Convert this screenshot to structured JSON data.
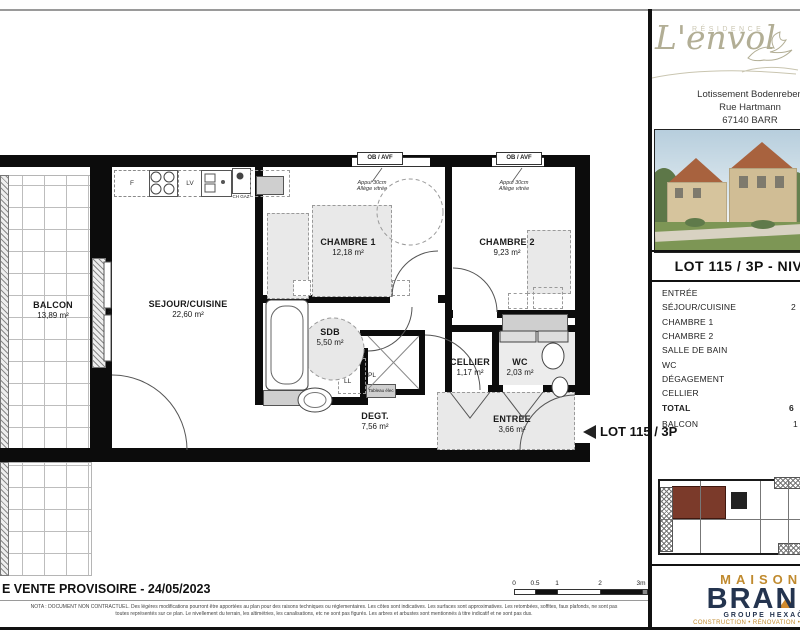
{
  "header": {
    "residence_label": "RÉSIDENCE",
    "residence_name": "L'envol",
    "address_line1": "Lotissement Bodenreben",
    "address_line2": "Rue Hartmann",
    "address_line3": "67140 BARR"
  },
  "lot_panel": {
    "title": "LOT 115 / 3P - NIVEAU",
    "rows": [
      {
        "label": "ENTRÉE",
        "value": ""
      },
      {
        "label": "SÉJOUR/CUISINE",
        "value": "2"
      },
      {
        "label": "CHAMBRE 1",
        "value": ""
      },
      {
        "label": "CHAMBRE 2",
        "value": ""
      },
      {
        "label": "SALLE DE BAIN",
        "value": ""
      },
      {
        "label": "WC",
        "value": ""
      },
      {
        "label": "DÉGAGEMENT",
        "value": ""
      },
      {
        "label": "CELLIER",
        "value": ""
      },
      {
        "label": "TOTAL",
        "value": "6"
      },
      {
        "label": "BALCON",
        "value": "1"
      }
    ]
  },
  "plan": {
    "rooms": [
      {
        "name": "BALCON",
        "area": "13,89 m²"
      },
      {
        "name": "SEJOUR/CUISINE",
        "area": "22,60 m²"
      },
      {
        "name": "CHAMBRE 1",
        "area": "12,18 m²"
      },
      {
        "name": "CHAMBRE 2",
        "area": "9,23 m²"
      },
      {
        "name": "SDB",
        "area": "5,50 m²"
      },
      {
        "name": "CELLIER",
        "area": "1,17 m²"
      },
      {
        "name": "WC",
        "area": "2,03 m²"
      },
      {
        "name": "DEGT.",
        "area": "7,56 m²"
      },
      {
        "name": "ENTREE",
        "area": "3,66 m²"
      }
    ],
    "annotations": {
      "window_label": "OB / AVF",
      "window_note_line1": "Appui 30cm",
      "window_note_line2": "Allège vitrée",
      "door_note": "Porte fenêtre + châssis fixe",
      "fridge": "F",
      "dishwasher": "LV",
      "boiler": "CH GAZ",
      "washer": "LL",
      "closet": "PL",
      "elec_panel": "Tableau élec",
      "lot_arrow_label": "LOT 115 / 3P"
    }
  },
  "footer": {
    "doc_title": "E VENTE PROVISOIRE - 24/05/2023",
    "legal_line1": "NOTA : DOCUMENT NON CONTRACTUEL. Des légères modifications pourront être apportées au plan pour des raisons techniques ou réglementaires. Les côtes sont indicatives. Les surfaces sont approximatives. Les retombées, soffites, faux plafonds, ne sont pas",
    "legal_line2": "toutes représentés sur ce plan. Le nivellement du terrain, les altimétries, les canalisations, etc ne sont pas figurés. Les arbres et arbustes sont mentionnés à titre indicatif et ne sont pas dus.",
    "scale_ticks": [
      "0",
      "0.5",
      "1",
      "2",
      "3m"
    ]
  },
  "brand": {
    "maisons": "MAISONS",
    "name": "BRAND",
    "group": "GROUPE HEXAÔM",
    "tagline": "CONSTRUCTION • RÉNOVATION • PROMOTION"
  },
  "colors": {
    "highlight_unit": "#7b3a2a",
    "brand_gold": "#c08a2e",
    "brand_navy": "#24344f",
    "script_olive": "#b2ae95"
  }
}
